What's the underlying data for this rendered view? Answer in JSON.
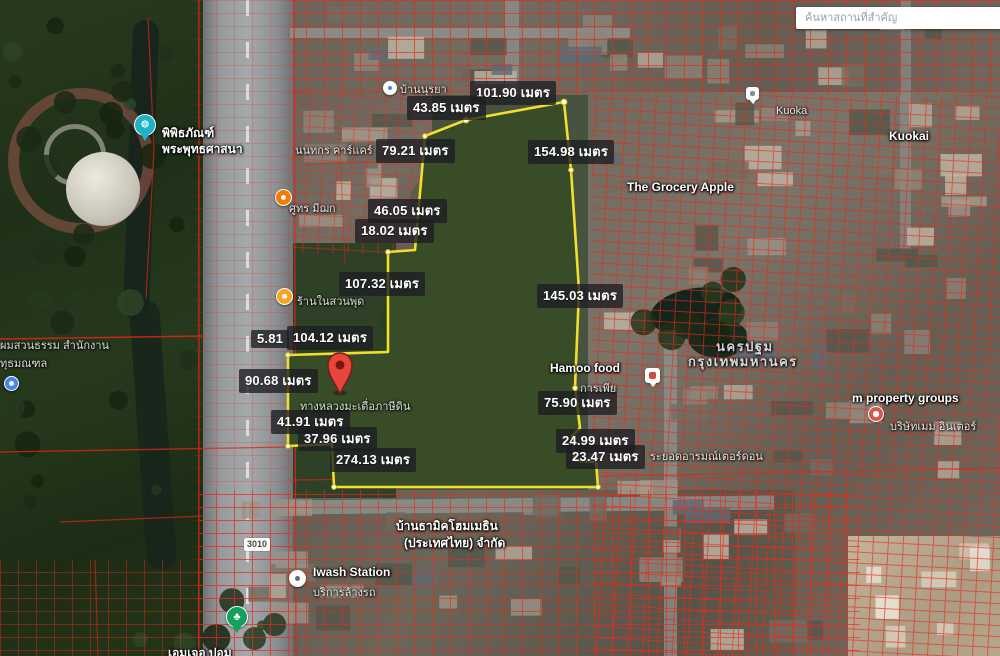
{
  "search": {
    "placeholder": "ค้นหาสถานที่สำคัญ"
  },
  "road_shield": {
    "text": "3010"
  },
  "unit": "เมตร",
  "measurements": [
    {
      "text": "101.90 เมตร",
      "x": 470,
      "y": 81
    },
    {
      "text": "43.85 เมตร",
      "x": 407,
      "y": 96
    },
    {
      "text": "79.21 เมตร",
      "x": 376,
      "y": 139
    },
    {
      "text": "154.98 เมตร",
      "x": 528,
      "y": 140
    },
    {
      "text": "46.05 เมตร",
      "x": 368,
      "y": 199
    },
    {
      "text": "18.02 เมตร",
      "x": 355,
      "y": 219
    },
    {
      "text": "107.32 เมตร",
      "x": 339,
      "y": 272
    },
    {
      "text": "5.81",
      "x": 251,
      "y": 330
    },
    {
      "text": "104.12 เมตร",
      "x": 287,
      "y": 326
    },
    {
      "text": "90.68 เมตร",
      "x": 239,
      "y": 369
    },
    {
      "text": "41.91 เมตร",
      "x": 271,
      "y": 410
    },
    {
      "text": "37.96 เมตร",
      "x": 298,
      "y": 427
    },
    {
      "text": "274.13 เมตร",
      "x": 330,
      "y": 448
    },
    {
      "text": "145.03 เมตร",
      "x": 537,
      "y": 284
    },
    {
      "text": "75.90 เมตร",
      "x": 538,
      "y": 391
    },
    {
      "text": "24.99 เมตร",
      "x": 556,
      "y": 429
    },
    {
      "text": "23.47 เมตร",
      "x": 566,
      "y": 445
    }
  ],
  "place_labels": [
    {
      "text": "พิพิธภัณฑ์",
      "x": 162,
      "y": 124,
      "kind": "place"
    },
    {
      "text": "พระพุทธศาสนา",
      "x": 162,
      "y": 140,
      "kind": "place"
    },
    {
      "text": "ผมสวนธรรม สำนักงาน",
      "x": 0,
      "y": 336,
      "kind": "faint"
    },
    {
      "text": "ทุธมณฑล",
      "x": 0,
      "y": 354,
      "kind": "faint"
    },
    {
      "text": "บ้านนุรยา",
      "x": 400,
      "y": 80,
      "kind": "faint"
    },
    {
      "text": "นนทกร คาร์แคร์",
      "x": 295,
      "y": 141,
      "kind": "faint"
    },
    {
      "text": "ศูทร มีฌก",
      "x": 289,
      "y": 199,
      "kind": "faint"
    },
    {
      "text": "ร้านในสวนพุด",
      "x": 297,
      "y": 292,
      "kind": "faint"
    },
    {
      "text": "The Grocery Apple",
      "x": 627,
      "y": 180,
      "kind": "place"
    },
    {
      "text": "Kuoka",
      "x": 776,
      "y": 105,
      "kind": "faint"
    },
    {
      "text": "Kuokai",
      "x": 889,
      "y": 129,
      "kind": "place"
    },
    {
      "text": "นครปฐม",
      "x": 716,
      "y": 336,
      "kind": "area"
    },
    {
      "text": "กรุงเทพมหานคร",
      "x": 688,
      "y": 351,
      "kind": "area"
    },
    {
      "text": "Hamoo food",
      "x": 550,
      "y": 361,
      "kind": "place"
    },
    {
      "text": "การเพีย",
      "x": 580,
      "y": 379,
      "kind": "faint"
    },
    {
      "text": "m property groups",
      "x": 852,
      "y": 391,
      "kind": "place"
    },
    {
      "text": "บริษัทเมม อินเตอร์",
      "x": 890,
      "y": 417,
      "kind": "faint"
    },
    {
      "text": "ระยอดอารมณ์เตอร์ดอน",
      "x": 650,
      "y": 447,
      "kind": "faint"
    },
    {
      "text": "ทางหลวงมะเดื่อภาษีดิน",
      "x": 300,
      "y": 397,
      "kind": "faint"
    },
    {
      "text": "บ้านธามิคโฮมเมธิน",
      "x": 396,
      "y": 517,
      "kind": "place"
    },
    {
      "text": "(ประเทศไทย) จำกัด",
      "x": 404,
      "y": 534,
      "kind": "place"
    },
    {
      "text": "Iwash Station",
      "x": 313,
      "y": 565,
      "kind": "place"
    },
    {
      "text": "บริการล้างรถ",
      "x": 313,
      "y": 583,
      "kind": "faint"
    },
    {
      "text": "เอมเจอ ปอม",
      "x": 168,
      "y": 644,
      "kind": "place"
    }
  ],
  "poi_icons": [
    {
      "name": "museum-pin",
      "type": "pin",
      "x": 134,
      "y": 114,
      "bg": "#1eb3c4",
      "glyph": "☸"
    },
    {
      "name": "restaurant-poi",
      "type": "circle",
      "x": 275,
      "y": 189,
      "bg": "#f57c00",
      "dot": "#ffffff",
      "size": 15
    },
    {
      "name": "shop-poi",
      "type": "circle",
      "x": 276,
      "y": 288,
      "bg": "#f6a623",
      "dot": "#ffffff",
      "size": 15
    },
    {
      "name": "transit-poi",
      "type": "circle",
      "x": 4,
      "y": 376,
      "bg": "#4285f4",
      "dot": "#ffffff",
      "size": 13
    },
    {
      "name": "hamoo-food-pin",
      "type": "sqpin",
      "x": 645,
      "y": 368,
      "bg": "#ffffff",
      "dot": "#c94f42",
      "size": 15
    },
    {
      "name": "kuoka-pin",
      "type": "sqpin",
      "x": 746,
      "y": 87,
      "bg": "#ffffff",
      "dot": "#8a8f96",
      "size": 13
    },
    {
      "name": "property-group-poi",
      "type": "circle",
      "x": 868,
      "y": 406,
      "bg": "#d8584a",
      "dot": "#ffffff",
      "size": 14
    },
    {
      "name": "carwash-poi",
      "type": "circle",
      "x": 289,
      "y": 570,
      "bg": "#ffffff",
      "dot": "#5f6b73",
      "size": 15
    },
    {
      "name": "park-pin",
      "type": "pin",
      "x": 226,
      "y": 606,
      "bg": "#12a05f",
      "glyph": "♣"
    },
    {
      "name": "nursery-poi",
      "type": "circle",
      "x": 383,
      "y": 81,
      "bg": "#ffffff",
      "dot": "#4285f4",
      "size": 12
    }
  ],
  "colors": {
    "parcel_outline": "#f2df2c",
    "cadastral_red": "#e8291c",
    "selected_pin_red": "#e8453c",
    "field_green": "#2e4527"
  }
}
